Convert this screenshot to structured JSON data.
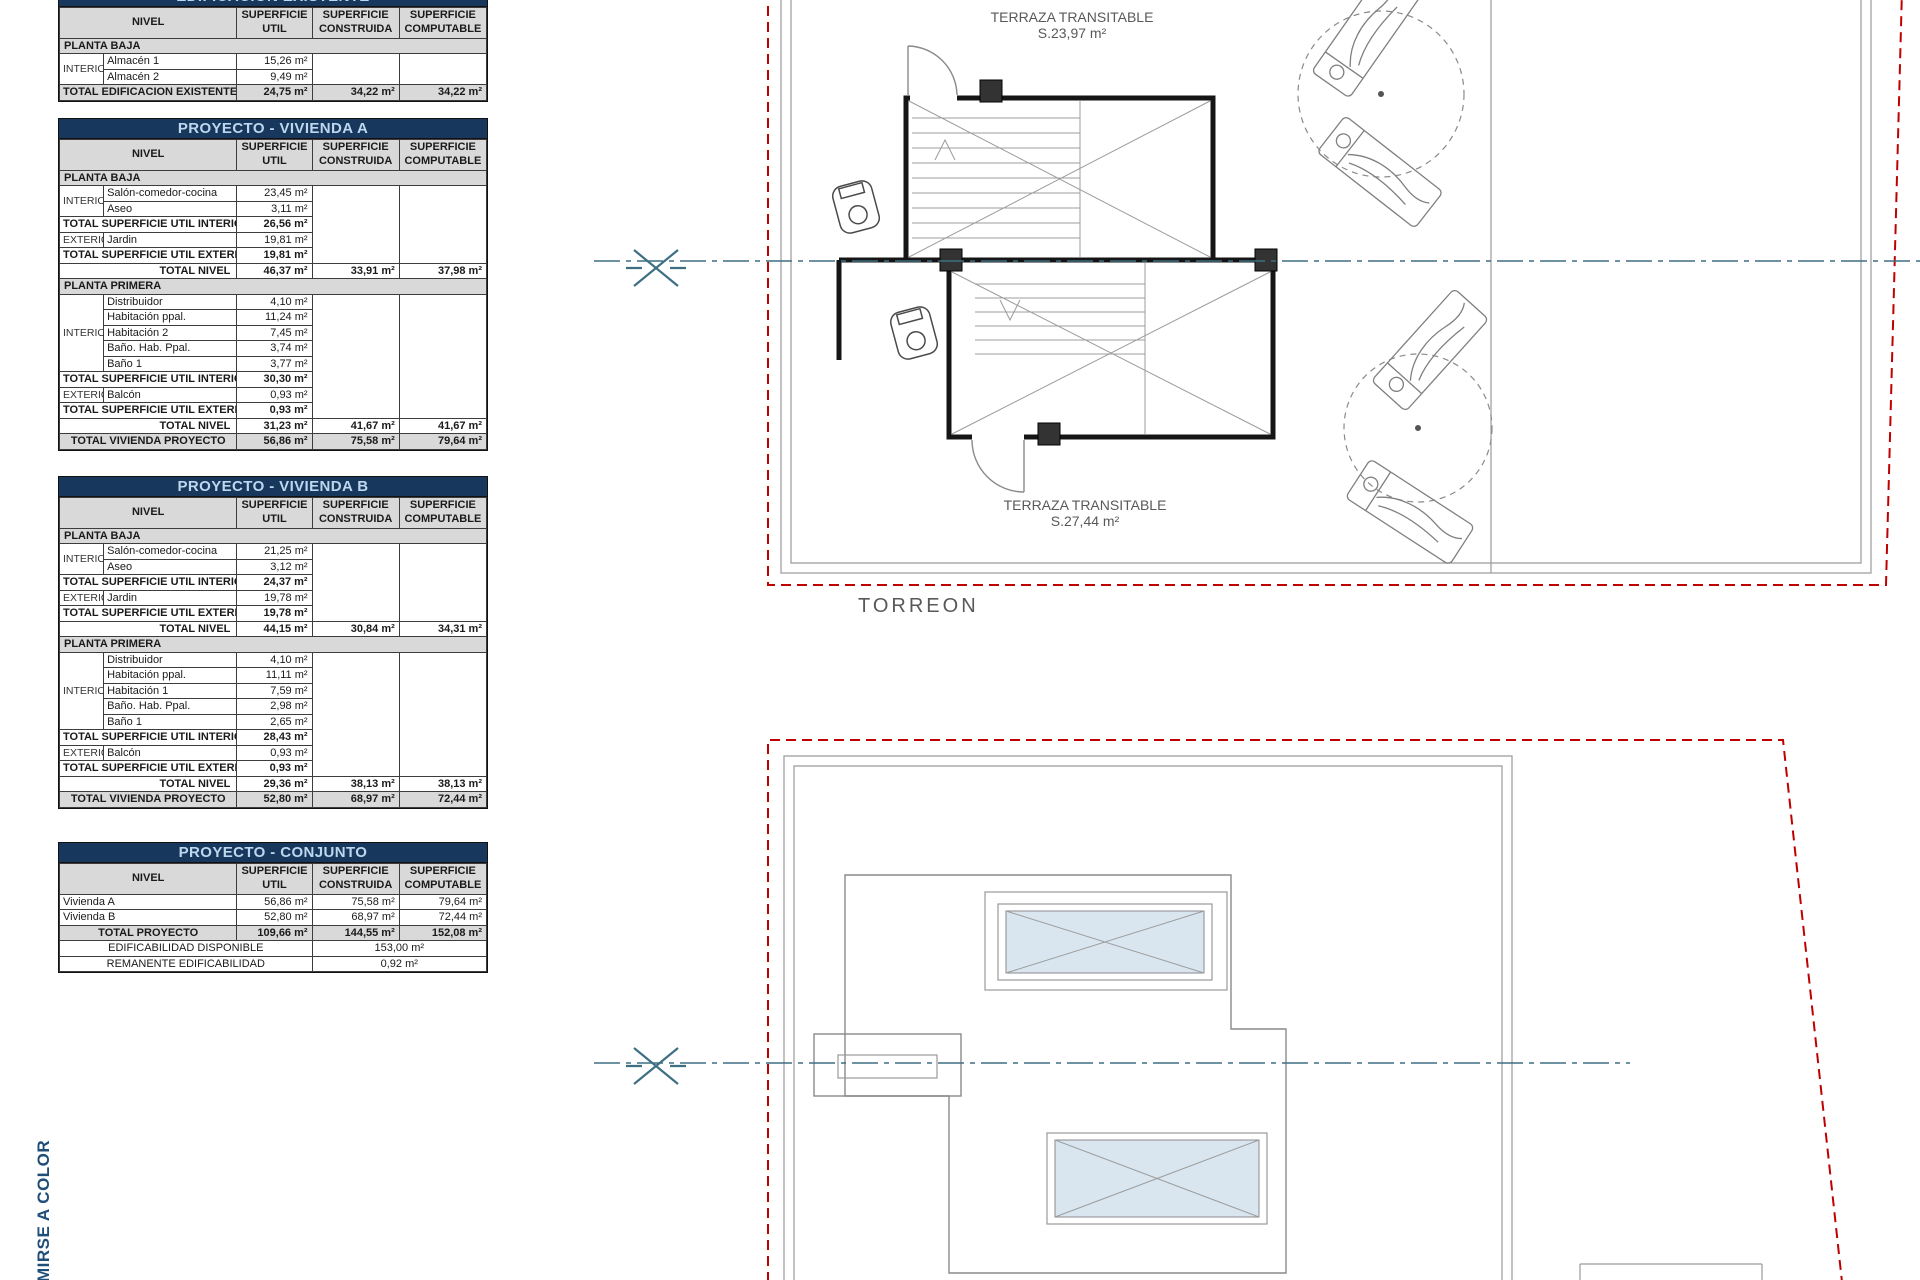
{
  "colors": {
    "title_bar_bg": "#17375D",
    "title_bar_text": "#BDD7EE",
    "header_bg": "#D9D9D9",
    "boundary_red": "#C00000",
    "centerline_teal": "#3E6F82",
    "skylight_fill": "#D9E6F0",
    "label_gray": "#595959",
    "side_text_blue": "#1F4E79"
  },
  "table_headers": {
    "nivel": "NIVEL",
    "cols": [
      [
        "SUPERFICIE",
        "UTIL"
      ],
      [
        "SUPERFICIE",
        "CONSTRUIDA"
      ],
      [
        "SUPERFICIE",
        "COMPUTABLE"
      ]
    ]
  },
  "tables": [
    {
      "id": "existente",
      "title": "EDIFICACION EXISTENTE",
      "rows": [
        {
          "t": "sec",
          "label": "PLANTA BAJA"
        },
        {
          "t": "room",
          "grp": "INTERIOR",
          "span": 2,
          "label": "Almacén 1",
          "util": "15,26 m²"
        },
        {
          "t": "room",
          "label": "Almacén 2",
          "util": "9,49 m²"
        },
        {
          "t": "grand",
          "label": "TOTAL EDIFICACION EXISTENTE",
          "util": "24,75 m²",
          "con": "34,22 m²",
          "comp": "34,22 m²"
        }
      ]
    },
    {
      "id": "vivienda_a",
      "title": "PROYECTO - VIVIENDA A",
      "rows": [
        {
          "t": "sec",
          "label": "PLANTA BAJA"
        },
        {
          "t": "room",
          "grp": "INTERIOR",
          "span": 2,
          "label": "Salón-comedor-cocina",
          "util": "23,45 m²"
        },
        {
          "t": "room",
          "label": "Aseo",
          "util": "3,11 m²"
        },
        {
          "t": "sub",
          "label": "TOTAL SUPERFICIE UTIL INTERIOR",
          "util": "26,56 m²"
        },
        {
          "t": "room",
          "grp": "EXTERIOR",
          "span": 1,
          "label": "Jardin",
          "util": "19,81 m²"
        },
        {
          "t": "sub",
          "label": "TOTAL SUPERFICIE UTIL EXTERIOR",
          "util": "19,81 m²"
        },
        {
          "t": "lvl",
          "label": "TOTAL NIVEL",
          "util": "46,37 m²",
          "con": "33,91 m²",
          "comp": "37,98 m²"
        },
        {
          "t": "sec",
          "label": "PLANTA PRIMERA"
        },
        {
          "t": "room",
          "grp": "INTERIOR",
          "span": 5,
          "label": "Distribuidor",
          "util": "4,10 m²"
        },
        {
          "t": "room",
          "label": "Habitación ppal.",
          "util": "11,24 m²"
        },
        {
          "t": "room",
          "label": "Habitación 2",
          "util": "7,45 m²"
        },
        {
          "t": "room",
          "label": "Baño. Hab. Ppal.",
          "util": "3,74 m²"
        },
        {
          "t": "room",
          "label": "Baño 1",
          "util": "3,77 m²"
        },
        {
          "t": "sub",
          "label": "TOTAL SUPERFICIE UTIL INTERIOR",
          "util": "30,30 m²"
        },
        {
          "t": "room",
          "grp": "EXTERIOR",
          "span": 1,
          "label": "Balcón",
          "util": "0,93 m²"
        },
        {
          "t": "sub",
          "label": "TOTAL SUPERFICIE UTIL EXTERIOR",
          "util": "0,93 m²"
        },
        {
          "t": "lvl",
          "label": "TOTAL NIVEL",
          "util": "31,23 m²",
          "con": "41,67 m²",
          "comp": "41,67 m²"
        },
        {
          "t": "grand",
          "label": "TOTAL VIVIENDA PROYECTO",
          "util": "56,86 m²",
          "con": "75,58 m²",
          "comp": "79,64 m²"
        }
      ]
    },
    {
      "id": "vivienda_b",
      "title": "PROYECTO - VIVIENDA B",
      "rows": [
        {
          "t": "sec",
          "label": "PLANTA BAJA"
        },
        {
          "t": "room",
          "grp": "INTERIOR",
          "span": 2,
          "label": "Salón-comedor-cocina",
          "util": "21,25 m²"
        },
        {
          "t": "room",
          "label": "Aseo",
          "util": "3,12 m²"
        },
        {
          "t": "sub",
          "label": "TOTAL SUPERFICIE UTIL INTERIOR",
          "util": "24,37 m²"
        },
        {
          "t": "room",
          "grp": "EXTERIOR",
          "span": 1,
          "label": "Jardin",
          "util": "19,78 m²"
        },
        {
          "t": "sub",
          "label": "TOTAL SUPERFICIE UTIL EXTERIOR",
          "util": "19,78 m²"
        },
        {
          "t": "lvl",
          "label": "TOTAL NIVEL",
          "util": "44,15 m²",
          "con": "30,84 m²",
          "comp": "34,31 m²"
        },
        {
          "t": "sec",
          "label": "PLANTA PRIMERA"
        },
        {
          "t": "room",
          "grp": "INTERIOR",
          "span": 5,
          "label": "Distribuidor",
          "util": "4,10 m²"
        },
        {
          "t": "room",
          "label": "Habitación ppal.",
          "util": "11,11 m²"
        },
        {
          "t": "room",
          "label": "Habitación 1",
          "util": "7,59 m²"
        },
        {
          "t": "room",
          "label": "Baño. Hab. Ppal.",
          "util": "2,98 m²"
        },
        {
          "t": "room",
          "label": "Baño 1",
          "util": "2,65 m²"
        },
        {
          "t": "sub",
          "label": "TOTAL SUPERFICIE UTIL INTERIOR",
          "util": "28,43 m²"
        },
        {
          "t": "room",
          "grp": "EXTERIOR",
          "span": 1,
          "label": "Balcón",
          "util": "0,93 m²"
        },
        {
          "t": "sub",
          "label": "TOTAL SUPERFICIE UTIL EXTERIOR",
          "util": "0,93 m²"
        },
        {
          "t": "lvl",
          "label": "TOTAL NIVEL",
          "util": "29,36 m²",
          "con": "38,13 m²",
          "comp": "38,13 m²"
        },
        {
          "t": "grand",
          "label": "TOTAL VIVIENDA PROYECTO",
          "util": "52,80 m²",
          "con": "68,97 m²",
          "comp": "72,44 m²"
        }
      ]
    },
    {
      "id": "conjunto",
      "title": "PROYECTO - CONJUNTO",
      "rows": [
        {
          "t": "plain",
          "label": "Vivienda A",
          "util": "56,86 m²",
          "con": "75,58 m²",
          "comp": "79,64 m²"
        },
        {
          "t": "plain",
          "label": "Vivienda B",
          "util": "52,80 m²",
          "con": "68,97 m²",
          "comp": "72,44 m²"
        },
        {
          "t": "grand",
          "label": "TOTAL PROYECTO",
          "util": "109,66 m²",
          "con": "144,55 m²",
          "comp": "152,08 m²"
        },
        {
          "t": "spanval",
          "label": "EDIFICABILIDAD DISPONIBLE",
          "value": "153,00 m²"
        },
        {
          "t": "spanval",
          "label": "REMANENTE EDIFICABILIDAD",
          "value": "0,92 m²"
        }
      ]
    }
  ],
  "drawings": {
    "top_plan": {
      "terrace_label_top": {
        "line1": "TERRAZA TRANSITABLE",
        "line2": "S.23,97 m²"
      },
      "terrace_label_bottom": {
        "line1": "TERRAZA TRANSITABLE",
        "line2": "S.27,44 m²"
      },
      "caption": "TORREON"
    },
    "side_text": "MIRSE A COLOR"
  }
}
